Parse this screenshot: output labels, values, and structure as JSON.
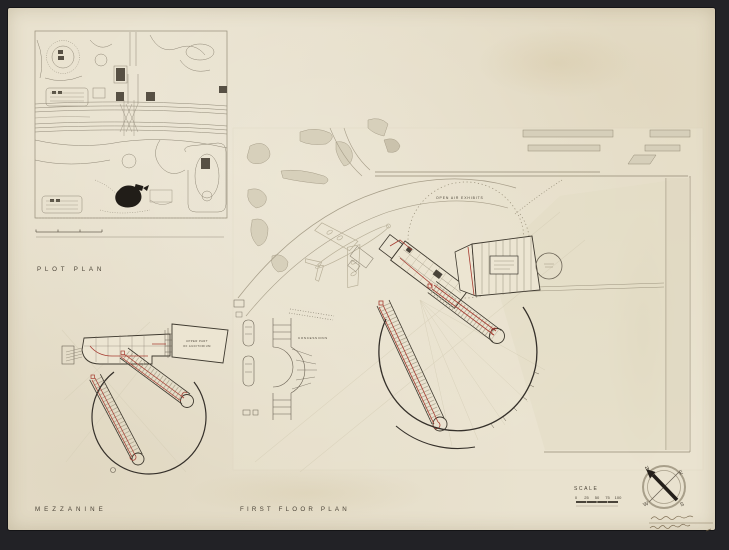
{
  "colors": {
    "background": "#26262a",
    "paper": "#e9e2cf",
    "ink_dark": "#3e392f",
    "ink_faint": "#8f8776",
    "accent_red": "#a63c31",
    "fill_gray": "#d7d0bb"
  },
  "plot_plan": {
    "label": "PLOT PLAN"
  },
  "mezzanine": {
    "label": "MEZZANINE",
    "upper_note_1": "UPPER PART",
    "upper_note_2": "OF AUDITORIUM"
  },
  "first_floor": {
    "label": "FIRST FLOOR PLAN",
    "open_air_label": "OPEN AIR EXHIBITS",
    "concessions_label": "CONCESSIONS"
  },
  "scale_bar": {
    "label": "SCALE",
    "ticks": [
      "0",
      "25",
      "50",
      "75",
      "100"
    ]
  },
  "compass": {
    "n": "N",
    "e": "E",
    "s": "S",
    "w": "W"
  }
}
